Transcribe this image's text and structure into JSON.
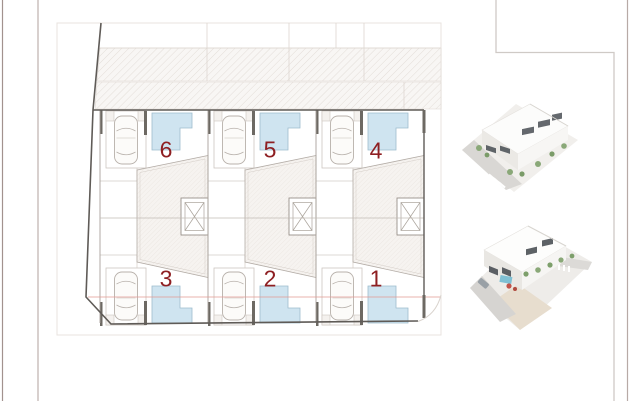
{
  "title": "Residential site plan with six townhouse plots and two aerial renders",
  "plan": {
    "units": [
      {
        "label": "6"
      },
      {
        "label": "5"
      },
      {
        "label": "4"
      },
      {
        "label": "3"
      },
      {
        "label": "2"
      },
      {
        "label": "1"
      }
    ],
    "features": [
      "parking-car-icon",
      "pool-shape",
      "stair-skylight-box",
      "street-hatch-band",
      "plot-boundary"
    ],
    "colors": {
      "pool_fill": "#cfe4f0",
      "pool_edge": "#9fbccd",
      "unit_number": "#8e1f22",
      "boundary_line": "#5f5b57",
      "sheet_line": "#e8e3df",
      "hatch_line": "#ddd6d0",
      "margin_line": "#a2928e"
    }
  },
  "renders": {
    "top": {
      "name": "aerial-render-front",
      "description": "white two-storey row houses, corner street with crosswalk, landscaping"
    },
    "bottom": {
      "name": "aerial-render-rear",
      "description": "white row houses with pool, car on street, crosswalk, landscaping"
    }
  }
}
